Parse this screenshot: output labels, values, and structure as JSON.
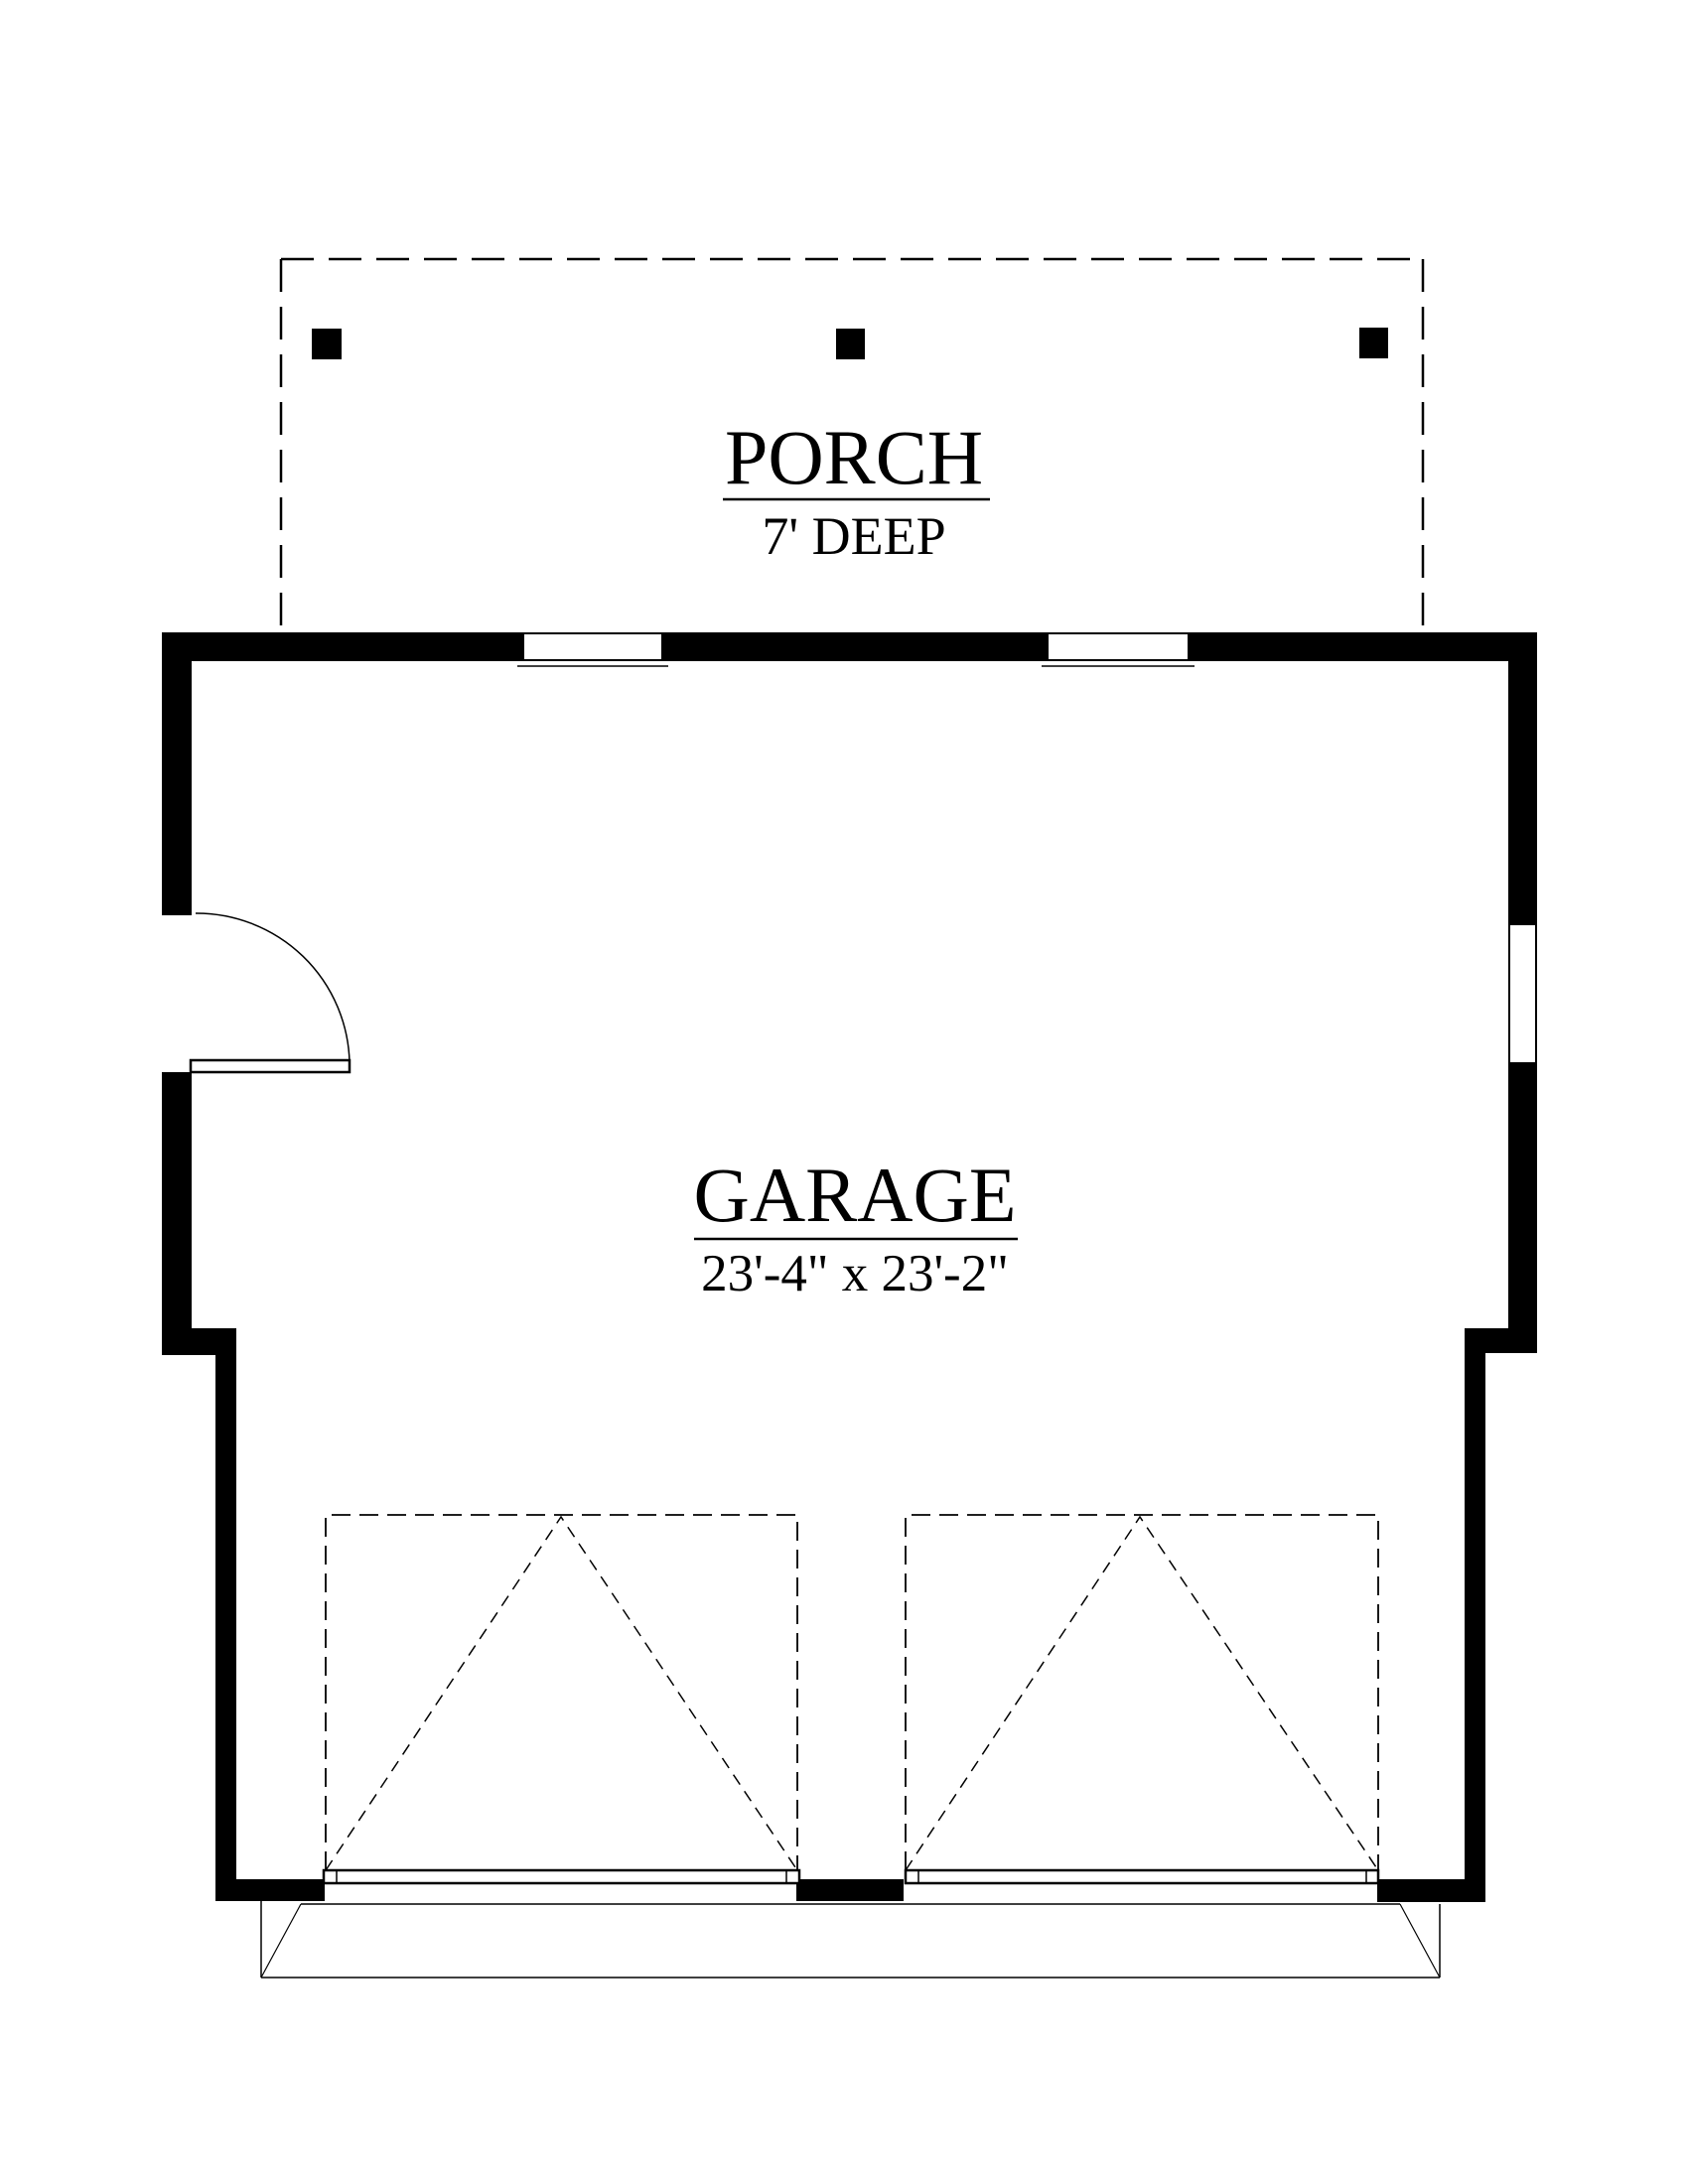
{
  "colors": {
    "ink": "#000000",
    "background": "#ffffff"
  },
  "porch": {
    "label": "PORCH",
    "depth": "7' DEEP",
    "post_count": 3
  },
  "garage": {
    "label": "GARAGE",
    "dimensions": "23'-4\" x 23'-2\""
  }
}
